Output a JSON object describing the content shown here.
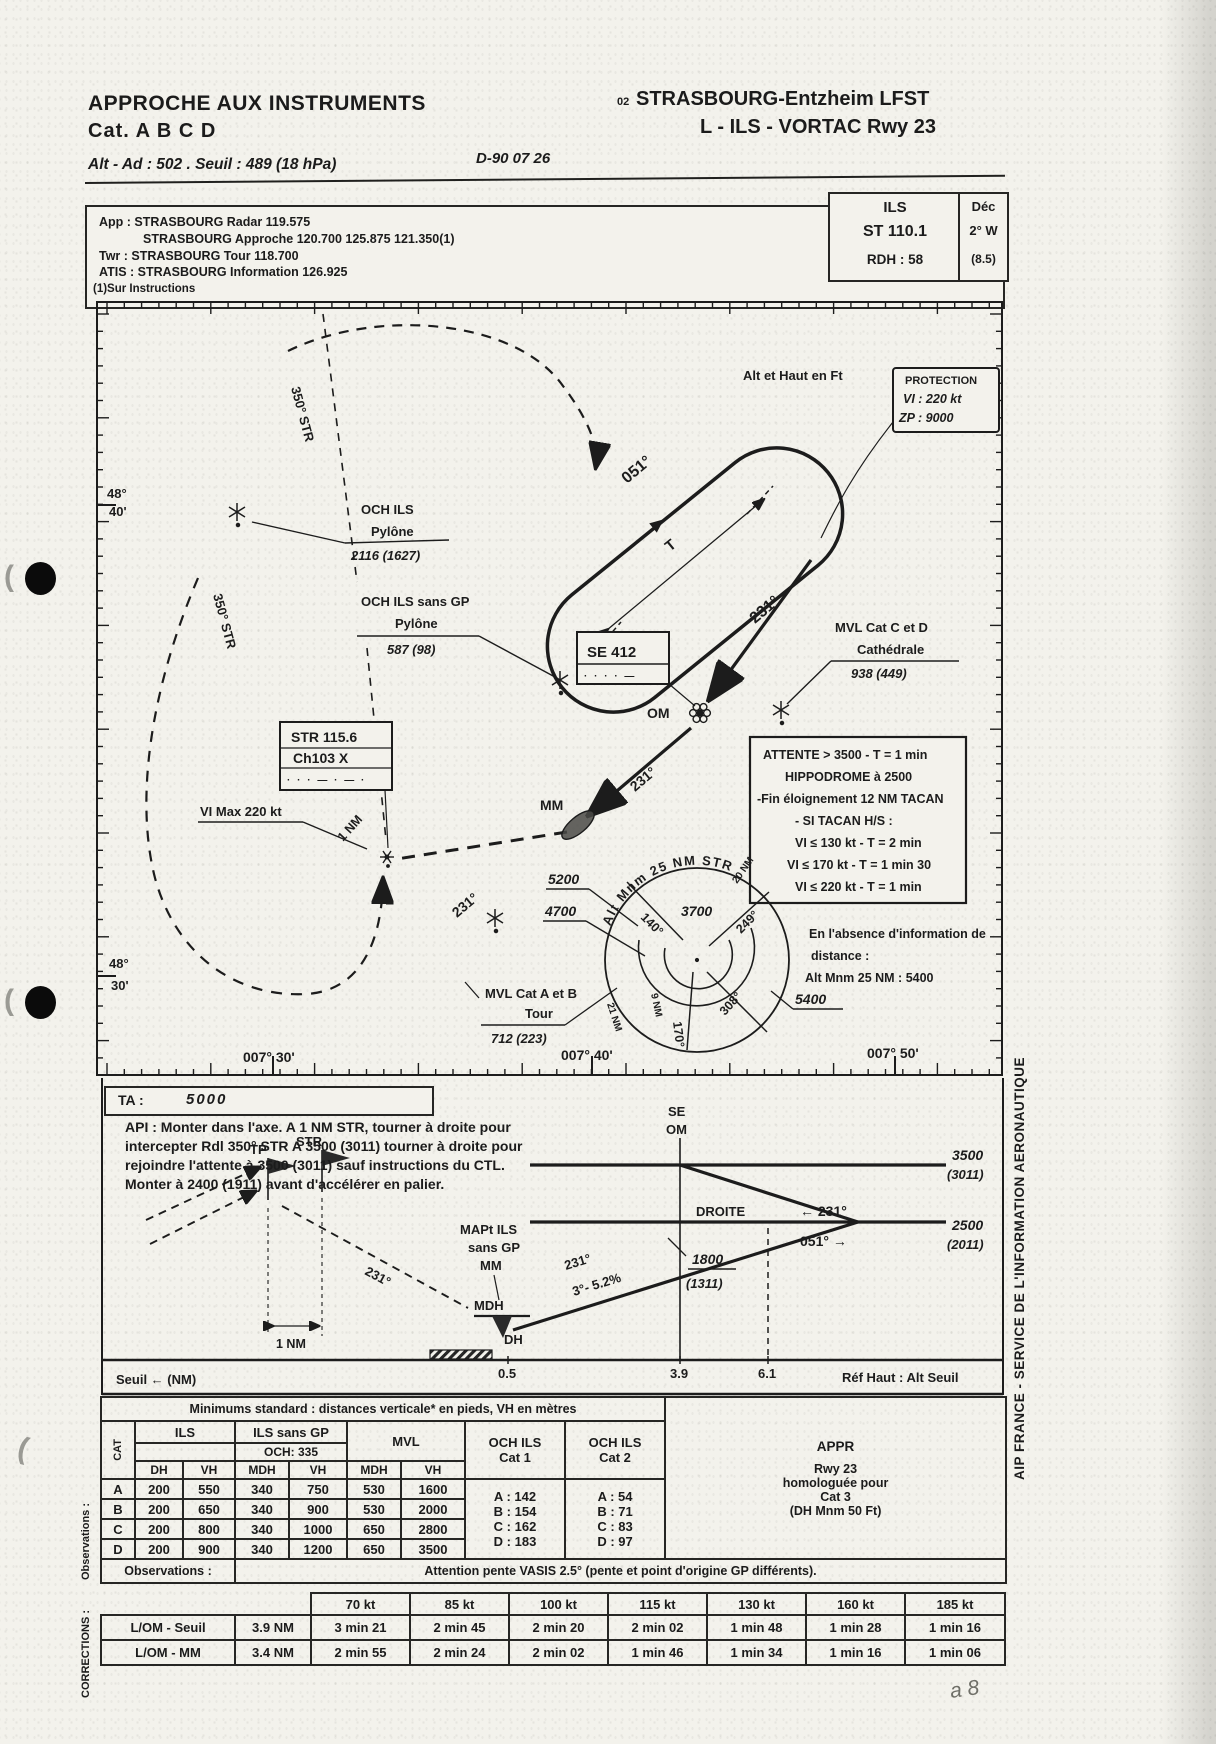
{
  "header": {
    "title1": "APPROCHE AUX INSTRUMENTS",
    "title2": "Cat.  A B C D",
    "alt_line": "Alt - Ad : 502 . Seuil : 489 (18 hPa)",
    "date": "D-90 07 26",
    "code": "02",
    "airport": "STRASBOURG-Entzheim  LFST",
    "proc": "L - ILS - VORTAC Rwy 23"
  },
  "freq": {
    "line1": "App : STRASBOURG Radar 119.575",
    "line2": "STRASBOURG Approche 120.700 125.875 121.350(1)",
    "line3": "Twr : STRASBOURG Tour 118.700",
    "line4": "ATIS : STRASBOURG Information 126.925",
    "note": "(1)Sur Instructions",
    "ils_title": "ILS",
    "ils_ident": "ST  110.1",
    "ils_rdh": "RDH :  58",
    "dec_title": "Déc",
    "dec_val": "2° W",
    "dec_sub": "(8.5)"
  },
  "map": {
    "lat1a": "48°",
    "lat1b": "40'",
    "lat2a": "48°",
    "lat2b": "30'",
    "lon1": "007° 30'",
    "lon2": "007° 40'",
    "lon3": "007° 50'",
    "radial1": "350° STR",
    "radial2": "350° STR",
    "alt_note": "Alt et Haut en Ft",
    "hold_out": "051°",
    "hold_t": "T",
    "hold_in": "231°",
    "protection": {
      "l1": "PROTECTION",
      "l2": "VI : 220 kt",
      "l3": "ZP :   9000"
    },
    "och1": {
      "l1": "OCH ILS",
      "l2": "Pylône",
      "l3": "2116 (1627)"
    },
    "och2": {
      "l1": "OCH ILS sans GP",
      "l2": "Pylône",
      "l3": "587 (98)"
    },
    "se_box": {
      "l1": "SE  412",
      "morse": "· · ·    · —"
    },
    "om": "OM",
    "mm": "MM",
    "mvl_cd": {
      "l1": "MVL Cat C et D",
      "l2": "Cathédrale",
      "l3": "938 (449)"
    },
    "attente": {
      "l1": "ATTENTE > 3500 - T = 1 min",
      "l2": "HIPPODROME à 2500",
      "l3": "-Fin éloignement 12 NM TACAN",
      "l4": "- SI TACAN H/S :",
      "l5": "VI ≤ 130 kt - T = 2 min",
      "l6": "VI ≤ 170 kt - T = 1 min 30",
      "l7": "VI ≤ 220 kt - T = 1 min"
    },
    "str_box": {
      "l1": "STR 115.6",
      "l2": "Ch103 X",
      "morse": "· · ·   —   · — ·"
    },
    "vi_max": "VI Max 220 kt",
    "one_nm": "1 NM",
    "trk2": "231°",
    "trk3": "231°",
    "msa": {
      "arc": "Alt  Mnm  25  NM  STR",
      "v1": "5200",
      "v2": "4700",
      "v3": "3700",
      "v4": "5400",
      "b1": "140°",
      "b2": "249°",
      "b3": "308°",
      "b4": "170°",
      "r1": "9 NM",
      "r2": "21 NM",
      "r3": "20 NM"
    },
    "mvl_ab": {
      "l1": "MVL Cat A et B",
      "l2": "Tour",
      "l3": "712 (223)"
    },
    "absence": {
      "l1": "En l'absence d'information de",
      "l2": "distance :",
      "l3": "Alt Mnm 25 NM : 5400"
    }
  },
  "profile": {
    "ta_label": "TA :",
    "ta_value": "5000",
    "api1": "API : Monter dans l'axe. A 1 NM STR, tourner à droite pour",
    "api2": "intercepter Rdl 350° STR A 3500 (3011) tourner à droite pour",
    "api3": "rejoindre l'attente à 3500 (3011) sauf instructions du CTL.",
    "api4": "Monter à 2400 (1911) avant d'accélérer en palier.",
    "se": "SE",
    "om": "OM",
    "droite": "DROITE",
    "alt1a": "3500",
    "alt1b": "(3011)",
    "alt2a": "2500",
    "alt2b": "(2011)",
    "crs_in": "← 231°",
    "crs_out": "051° →",
    "tp": "TP",
    "str": "STR",
    "one_nm": "1 NM",
    "trk": "231°",
    "mapt1": "MAPt ILS",
    "mapt2": "sans GP",
    "mapt3": "MM",
    "mdh": "MDH",
    "dh": "DH",
    "gs1": "231°",
    "gs2": "3°- 5.2%",
    "fix1a": "1800",
    "fix1b": "(1311)",
    "d1": "0.5",
    "d2": "3.9",
    "d3": "6.1",
    "seuil": "Seuil ← (NM)",
    "ref": "Réf Haut : Alt Seuil"
  },
  "minimums": {
    "title": "Minimums standard : distances verticale* en pieds, VH en mètres",
    "cat": "CAT",
    "h_ils": "ILS",
    "h_ils_gp": "ILS sans GP",
    "h_och335": "OCH: 335",
    "h_mvl": "MVL",
    "h_och1a": "OCH ILS",
    "h_och1b": "Cat 1",
    "h_och2a": "OCH ILS",
    "h_och2b": "Cat 2",
    "h_appr": "APPR",
    "sub": [
      "DH",
      "VH",
      "MDH",
      "VH",
      "MDH",
      "VH"
    ],
    "rows": [
      {
        "cat": "A",
        "v": [
          "200",
          "550",
          "340",
          "750",
          "530",
          "1600"
        ],
        "och1": "A :  142",
        "och2": "A :  54"
      },
      {
        "cat": "B",
        "v": [
          "200",
          "650",
          "340",
          "900",
          "530",
          "2000"
        ],
        "och1": "B :  154",
        "och2": "B :  71"
      },
      {
        "cat": "C",
        "v": [
          "200",
          "800",
          "340",
          "1000",
          "650",
          "2800"
        ],
        "och1": "C :  162",
        "och2": "C :  83"
      },
      {
        "cat": "D",
        "v": [
          "200",
          "900",
          "340",
          "1200",
          "650",
          "3500"
        ],
        "och1": "D :  183",
        "och2": "D :  97"
      }
    ],
    "appr": [
      "Rwy 23",
      "homologuée pour",
      "Cat 3",
      "(DH Mnm 50 Ft)"
    ],
    "obs_label": "Observations :",
    "obs_text": "Attention pente VASIS 2.5° (pente et point d'origine GP différents)."
  },
  "corrections": {
    "side_obs": "Observations :",
    "side_corr": "CORRECTIONS :",
    "speeds": [
      "70 kt",
      "85 kt",
      "100 kt",
      "115 kt",
      "130 kt",
      "160 kt",
      "185 kt"
    ],
    "rows": [
      {
        "label": "L/OM - Seuil",
        "dist": "3.9 NM",
        "t": [
          "3 min 21",
          "2 min 45",
          "2 min 20",
          "2 min 02",
          "1 min 48",
          "1 min 28",
          "1 min 16"
        ]
      },
      {
        "label": "L/OM - MM",
        "dist": "3.4 NM",
        "t": [
          "2 min 55",
          "2 min 24",
          "2 min 02",
          "1 min 46",
          "1 min 34",
          "1 min 16",
          "1 min 06"
        ]
      }
    ]
  },
  "margin": {
    "right": "AIP FRANCE - SERVICE DE L'INFORMATION AERONAUTIQUE",
    "handwriting": "a 8"
  }
}
